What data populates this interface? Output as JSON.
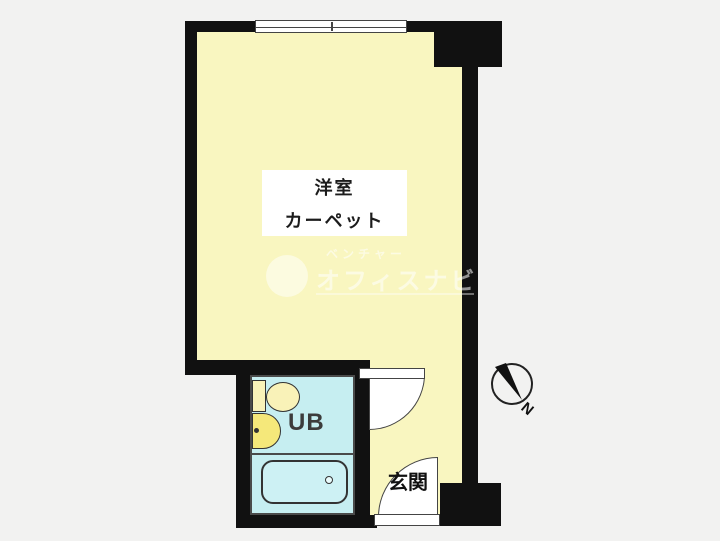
{
  "floorplan": {
    "main_room": {
      "name": "洋室",
      "finish": "カーペット"
    },
    "unit_bath": {
      "label": "UB"
    },
    "entrance": {
      "label": "玄関"
    },
    "compass": {
      "north_label": "N"
    },
    "watermark": {
      "line1": "ベンチャー",
      "line2": "オフィスナビ"
    },
    "colors": {
      "wall": "#111111",
      "room_fill": "#f9f6c0",
      "bath_fill": "#c6eef1",
      "fixture_yellow": "#f5e87a",
      "fixture_cream": "#f9f2b8",
      "background": "#f2f2f1",
      "door_white": "#ffffff"
    }
  }
}
